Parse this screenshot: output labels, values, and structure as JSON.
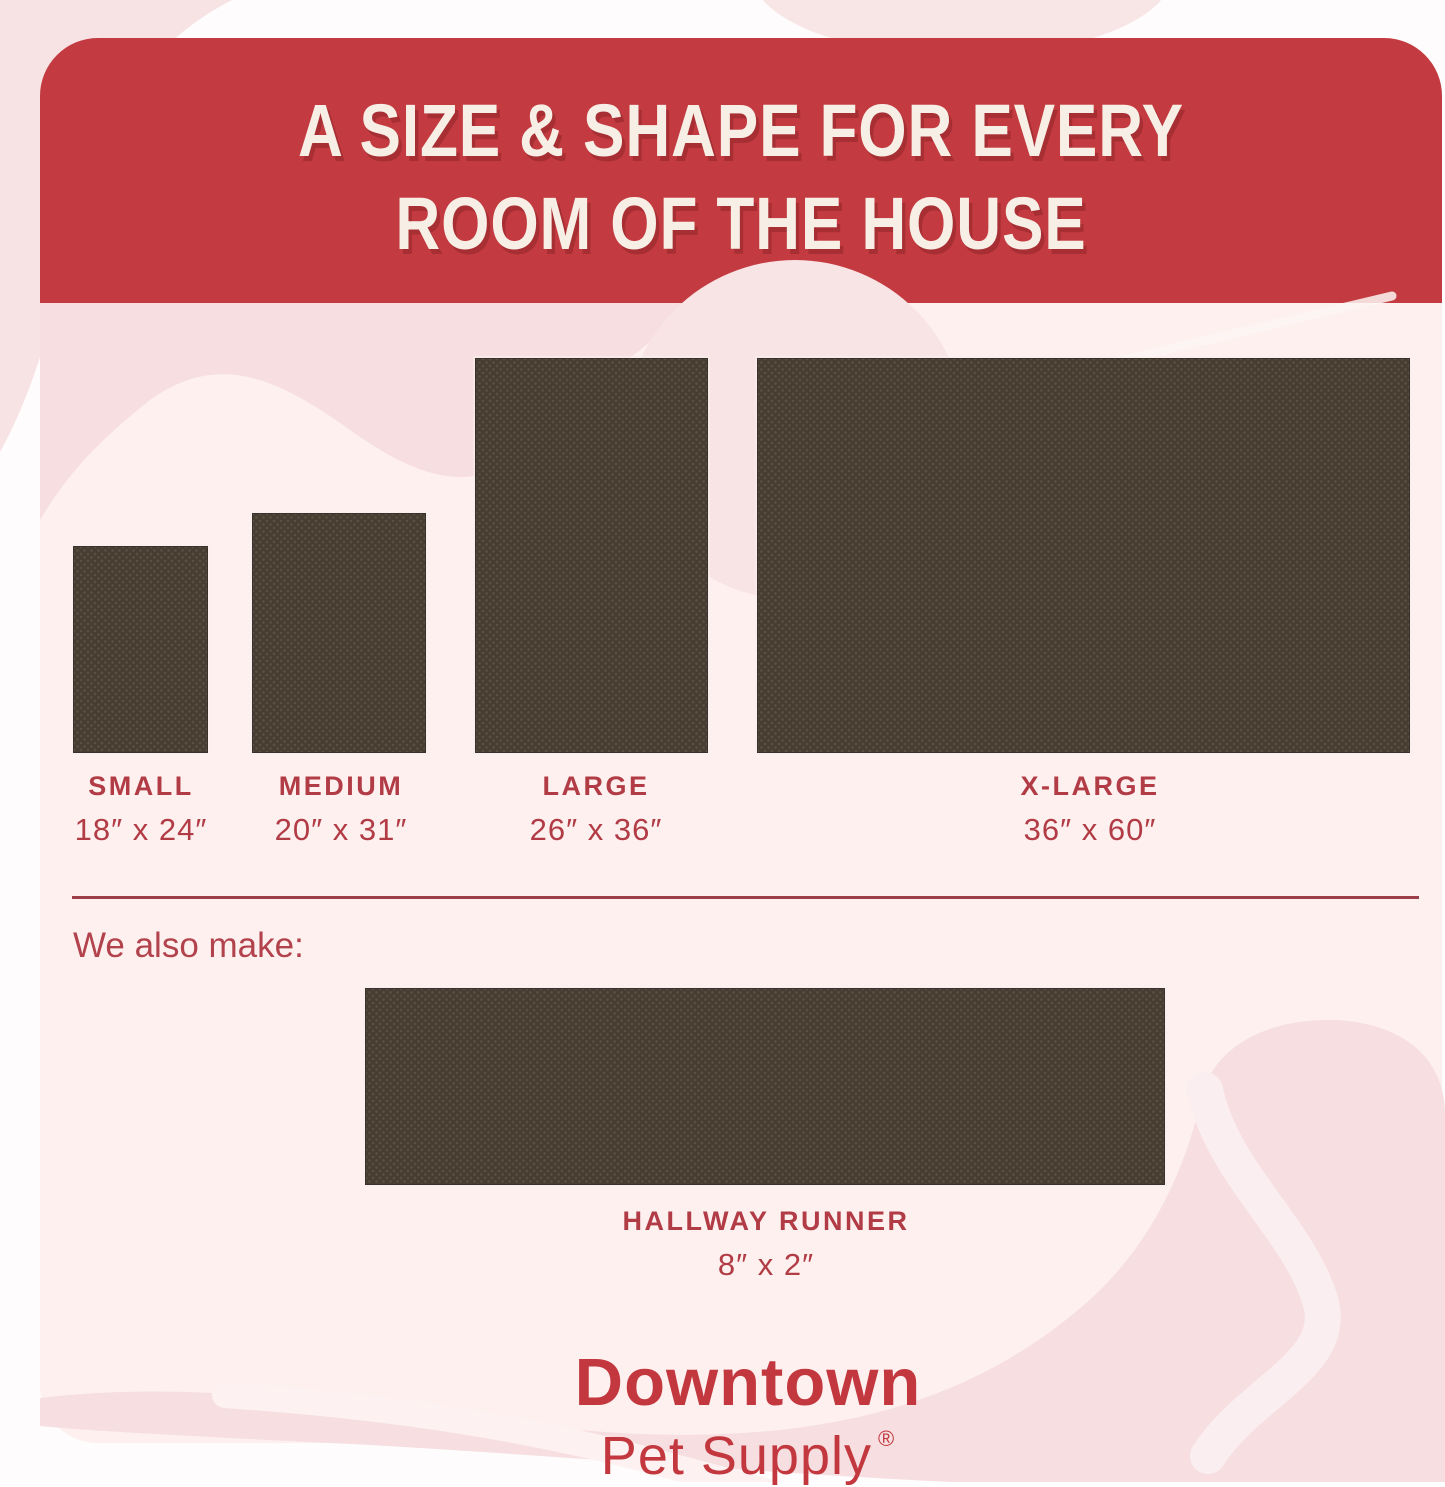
{
  "header": {
    "title_line1": "A SIZE & SHAPE FOR EVERY",
    "title_line2": "ROOM OF THE HOUSE"
  },
  "sizes": [
    {
      "id": "small",
      "label": "SMALL",
      "dims": "18″ x 24″"
    },
    {
      "id": "medium",
      "label": "MEDIUM",
      "dims": "20″ x 31″"
    },
    {
      "id": "large",
      "label": "LARGE",
      "dims": "26″ x 36″"
    },
    {
      "id": "xlarge",
      "label": "X-LARGE",
      "dims": "36″ x 60″"
    }
  ],
  "also": {
    "heading": "We also make:",
    "label": "HALLWAY RUNNER",
    "dims": "8″ x 2″"
  },
  "brand": {
    "name": "Downtown",
    "line2": "Pet Supply",
    "registered": "®"
  },
  "colors": {
    "banner_red": "#c33b40",
    "title_cream": "#f7efe6",
    "label_red": "#b23c46",
    "divider_red": "#9c3f48",
    "logo_red": "#c2383e",
    "card_pink": "#fdf0ef",
    "swirl_pink": "#f6dee1",
    "mat_brown": "#473d32",
    "mat_dot": "#5a4f40"
  }
}
